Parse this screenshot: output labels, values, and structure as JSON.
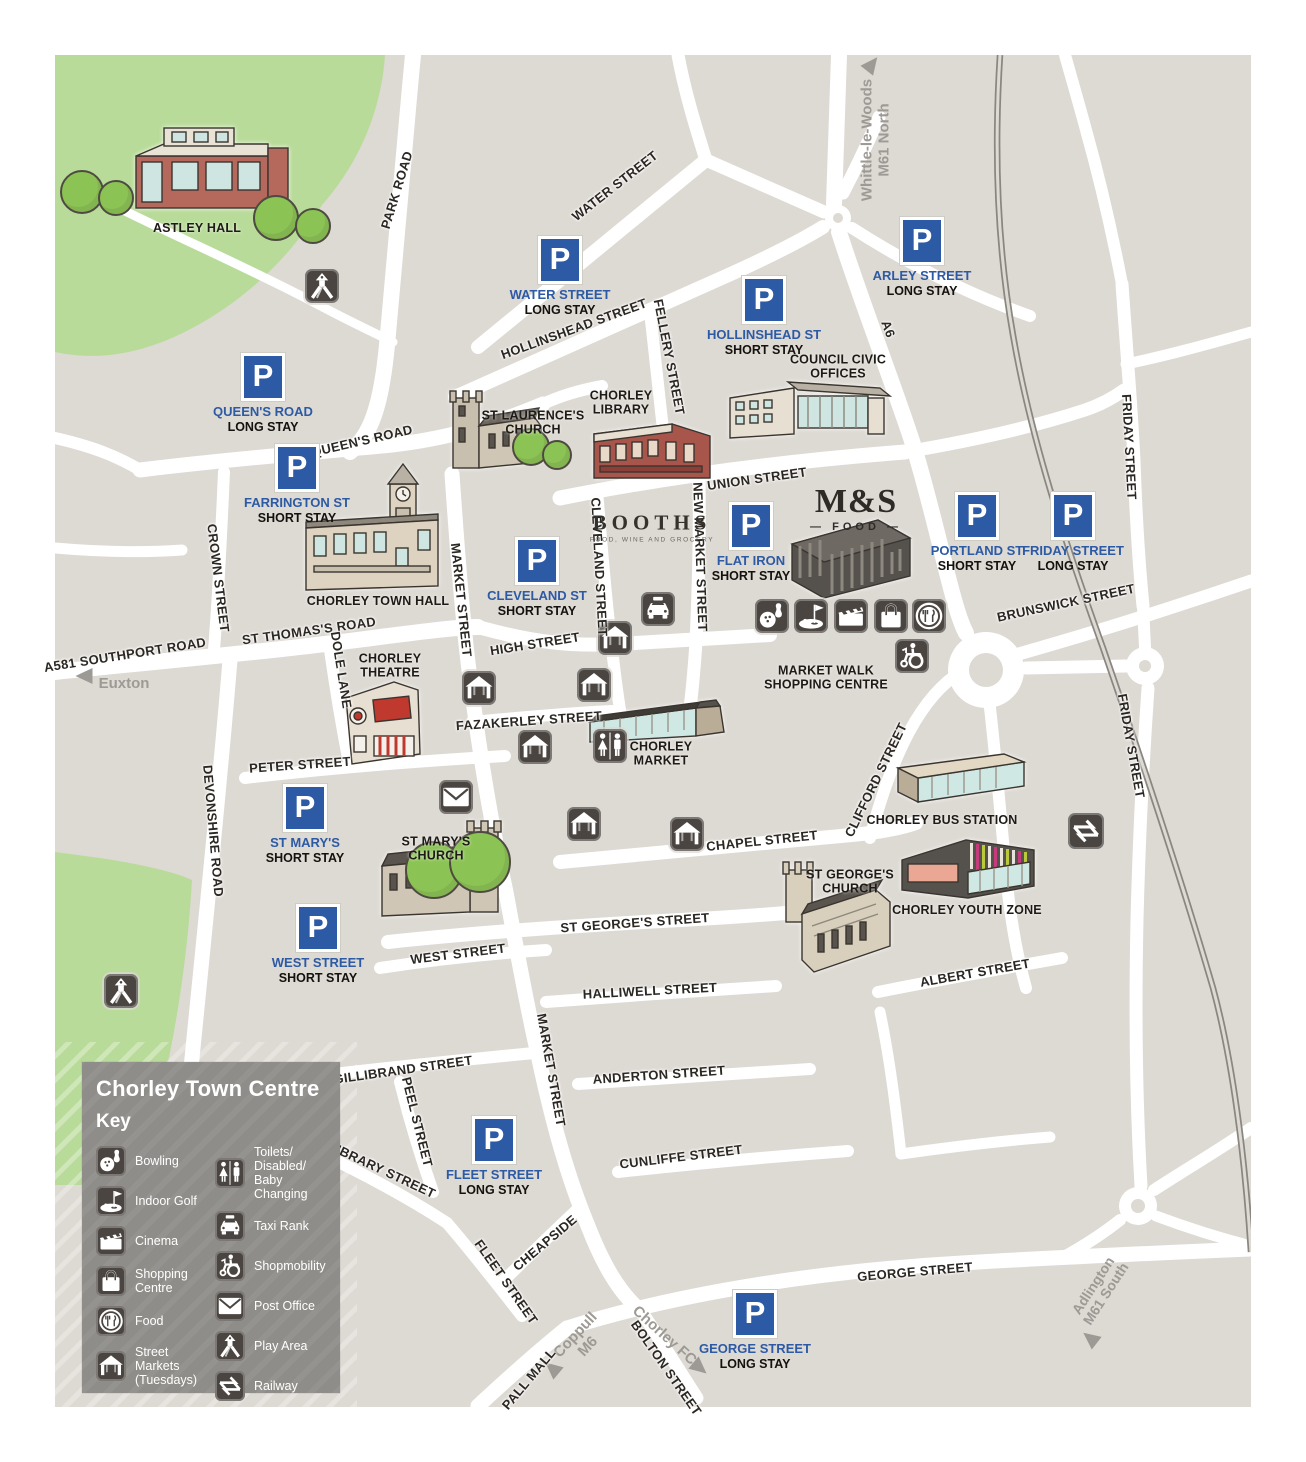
{
  "map_title": "Chorley Town Centre",
  "parking_symbol": "P",
  "key": {
    "heading": "Chorley Town Centre",
    "subheading": "Key",
    "items": [
      {
        "icon": "bowling-icon",
        "label": "Bowling"
      },
      {
        "icon": "indoor-golf-icon",
        "label": "Indoor Golf"
      },
      {
        "icon": "cinema-icon",
        "label": "Cinema"
      },
      {
        "icon": "shopping-centre-icon",
        "label": "Shopping\nCentre"
      },
      {
        "icon": "food-icon",
        "label": "Food"
      },
      {
        "icon": "street-markets-icon",
        "label": "Street Markets\n(Tuesdays)"
      },
      {
        "icon": "toilets-icon",
        "label": "Toilets/\nDisabled/\nBaby Changing"
      },
      {
        "icon": "taxi-rank-icon",
        "label": "Taxi Rank"
      },
      {
        "icon": "shopmobility-icon",
        "label": "Shopmobility"
      },
      {
        "icon": "post-office-icon",
        "label": "Post Office"
      },
      {
        "icon": "play-area-icon",
        "label": "Play Area"
      },
      {
        "icon": "railway-icon",
        "label": "Railway"
      }
    ]
  },
  "parking_signs": [
    {
      "name": "QUEEN'S ROAD",
      "stay": "LONG STAY"
    },
    {
      "name": "FARRINGTON ST",
      "stay": "SHORT STAY"
    },
    {
      "name": "WATER STREET",
      "stay": "LONG STAY"
    },
    {
      "name": "HOLLINSHEAD ST",
      "stay": "SHORT STAY"
    },
    {
      "name": "ARLEY STREET",
      "stay": "LONG STAY"
    },
    {
      "name": "CLEVELAND ST",
      "stay": "SHORT STAY"
    },
    {
      "name": "FLAT IRON",
      "stay": "SHORT STAY"
    },
    {
      "name": "PORTLAND ST",
      "stay": "SHORT STAY"
    },
    {
      "name": "FRIDAY STREET",
      "stay": "LONG STAY"
    },
    {
      "name": "ST MARY'S",
      "stay": "SHORT STAY"
    },
    {
      "name": "WEST STREET",
      "stay": "SHORT STAY"
    },
    {
      "name": "FLEET STREET",
      "stay": "LONG STAY"
    },
    {
      "name": "GEORGE STREET",
      "stay": "LONG STAY"
    }
  ],
  "streets": [
    {
      "label": "PARK ROAD"
    },
    {
      "label": "WATER STREET"
    },
    {
      "label": "HOLLINSHEAD STREET"
    },
    {
      "label": "FELLERY STREET"
    },
    {
      "label": "QUEEN'S ROAD"
    },
    {
      "label": "UNION STREET"
    },
    {
      "label": "CROWN STREET"
    },
    {
      "label": "MARKET STREET"
    },
    {
      "label": "CLEVELAND STREET"
    },
    {
      "label": "NEW MARKET STREET"
    },
    {
      "label": "A6"
    },
    {
      "label": "FRIDAY STREET"
    },
    {
      "label": "BRUNSWICK STREET"
    },
    {
      "label": "ST THOMAS'S ROAD"
    },
    {
      "label": "A581 SOUTHPORT ROAD"
    },
    {
      "label": "DOLE LANE"
    },
    {
      "label": "HIGH STREET"
    },
    {
      "label": "FAZAKERLEY STREET"
    },
    {
      "label": "PETER STREET"
    },
    {
      "label": "DEVONSHIRE ROAD"
    },
    {
      "label": "CHAPEL STREET"
    },
    {
      "label": "CLIFFORD STREET"
    },
    {
      "label": "FRIDAY STREET"
    },
    {
      "label": "ST GEORGE'S STREET"
    },
    {
      "label": "WEST STREET"
    },
    {
      "label": "HALLIWELL STREET"
    },
    {
      "label": "ALBERT STREET"
    },
    {
      "label": "GILLIBRAND STREET"
    },
    {
      "label": "ANDERTON STREET"
    },
    {
      "label": "MARKET STREET"
    },
    {
      "label": "PEEL STREET"
    },
    {
      "label": "LIBRARY STREET"
    },
    {
      "label": "CUNLIFFE STREET"
    },
    {
      "label": "CHEAPSIDE"
    },
    {
      "label": "FLEET STREET"
    },
    {
      "label": "GEORGE STREET"
    },
    {
      "label": "BOLTON STREET"
    },
    {
      "label": "PALL MALL"
    }
  ],
  "landmarks": [
    {
      "name": "ASTLEY HALL"
    },
    {
      "name": "ST LAURENCE'S\nCHURCH"
    },
    {
      "name": "CHORLEY\nLIBRARY"
    },
    {
      "name": "COUNCIL CIVIC\nOFFICES"
    },
    {
      "name": "CHORLEY TOWN HALL"
    },
    {
      "name": "CHORLEY\nTHEATRE"
    },
    {
      "name": "MARKET WALK\nSHOPPING CENTRE"
    },
    {
      "name": "CHORLEY\nMARKET"
    },
    {
      "name": "ST MARY'S\nCHURCH"
    },
    {
      "name": "ST GEORGE'S\nCHURCH"
    },
    {
      "name": "CHORLEY BUS STATION"
    },
    {
      "name": "CHORLEY YOUTH ZONE"
    }
  ],
  "directions": [
    {
      "label": "Whittle-le-Woods\nM61 North"
    },
    {
      "label": "Euxton"
    },
    {
      "label": "Coppull\nM6"
    },
    {
      "label": "Chorley FC"
    },
    {
      "label": "Adlington\nM61 South"
    }
  ],
  "stores": {
    "booths": "BOOTHS",
    "booths_sub": "FOOD, WINE AND GROCERY",
    "ms": "M&S",
    "ms_sub": "— FOOD —"
  },
  "colors": {
    "background": "#ddd9d3",
    "road": "#ffffff",
    "park_green": "#b9db9a",
    "parking_blue": "#2d5aa5",
    "icon_dark": "#4a4540",
    "railway_gray": "#8a8781",
    "direction_gray": "#9d9994"
  }
}
